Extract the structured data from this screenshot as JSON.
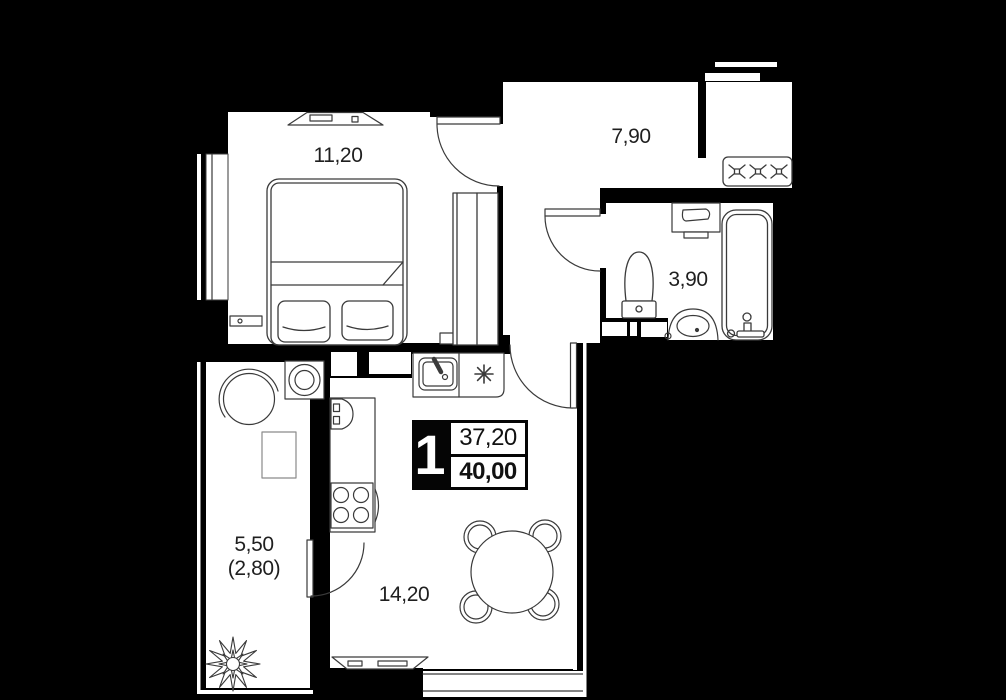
{
  "plan": {
    "title": "1-room apartment floor plan",
    "badge": {
      "rooms_count": "1",
      "living_area": "37,20",
      "total_area": "40,00"
    },
    "rooms": [
      {
        "id": "bedroom",
        "area_label": "11,20"
      },
      {
        "id": "hallway",
        "area_label": "7,90"
      },
      {
        "id": "bathroom",
        "area_label": "3,90"
      },
      {
        "id": "kitchen-living",
        "area_label": "14,20"
      },
      {
        "id": "balcony",
        "area_label": "5,50",
        "area_label_2": "(2,80)"
      }
    ],
    "icons": {
      "stove_connection": "asterisk-burst",
      "closet_section": "x-cross"
    },
    "colors": {
      "background": "#000000",
      "floor": "#ffffff",
      "line": "#3a3a3a",
      "text": "#1f1f1f"
    }
  }
}
